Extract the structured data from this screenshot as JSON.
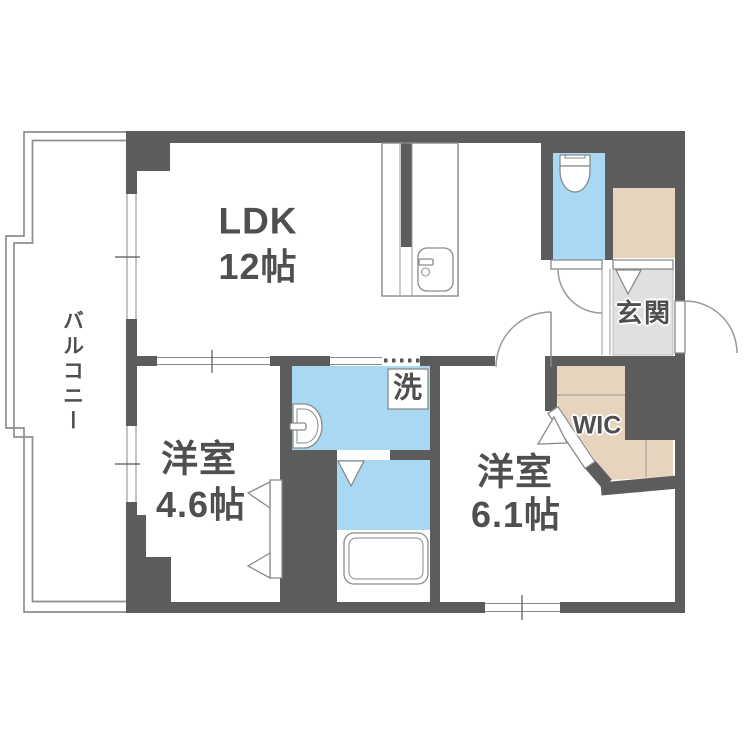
{
  "colors": {
    "wall": "#5c5c5c",
    "water": "#a9d8f2",
    "storage": "#e7d4bf",
    "entrance_floor": "#e0e0e0",
    "fixture_outline": "#8a8a8a",
    "text": "#4f4f4f"
  },
  "rooms": {
    "ldk": {
      "name": "LDK",
      "size": "12帖"
    },
    "bedroom_a": {
      "name": "洋室",
      "size": "4.6帖"
    },
    "bedroom_b": {
      "name": "洋室",
      "size": "6.1帖"
    },
    "balcony": {
      "name": "バルコニー"
    },
    "entrance": {
      "name": "玄関"
    },
    "walk_in_closet": {
      "name": "WIC"
    },
    "laundry": {
      "name": "洗"
    }
  }
}
